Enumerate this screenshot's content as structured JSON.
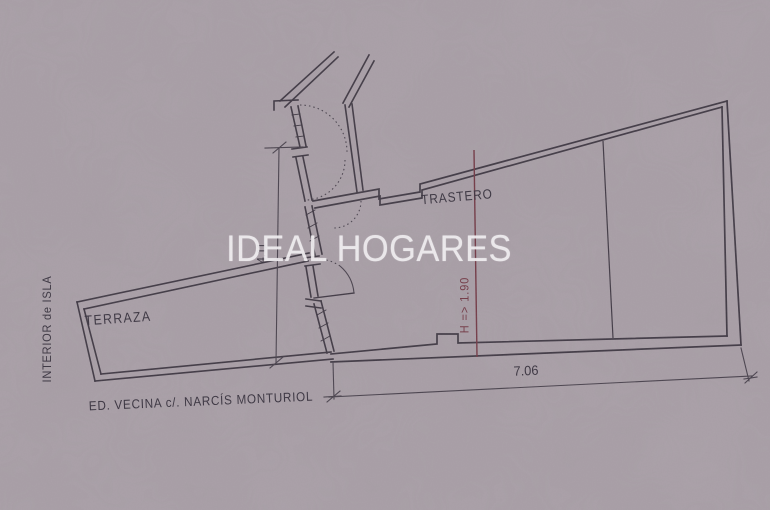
{
  "watermark": {
    "text": "IDEAL HOGARES",
    "color": "#f3f0f3"
  },
  "plan": {
    "rooms": [
      {
        "name": "TRASTERO"
      },
      {
        "name": "TERRAZA"
      }
    ],
    "exterior": {
      "left": "INTERIOR de ISLA",
      "bottom": "ED. VECINA c/. NARCÍS MONTURIOL"
    },
    "dimensions": [
      {
        "label": "7.06",
        "orientation": "horizontal"
      },
      {
        "label": "4.11",
        "orientation": "vertical"
      }
    ],
    "height_note": {
      "label": "H => 1.90",
      "color": "#733a46"
    },
    "colors": {
      "ink": "#413a45",
      "paper": "#a89ea6"
    }
  }
}
